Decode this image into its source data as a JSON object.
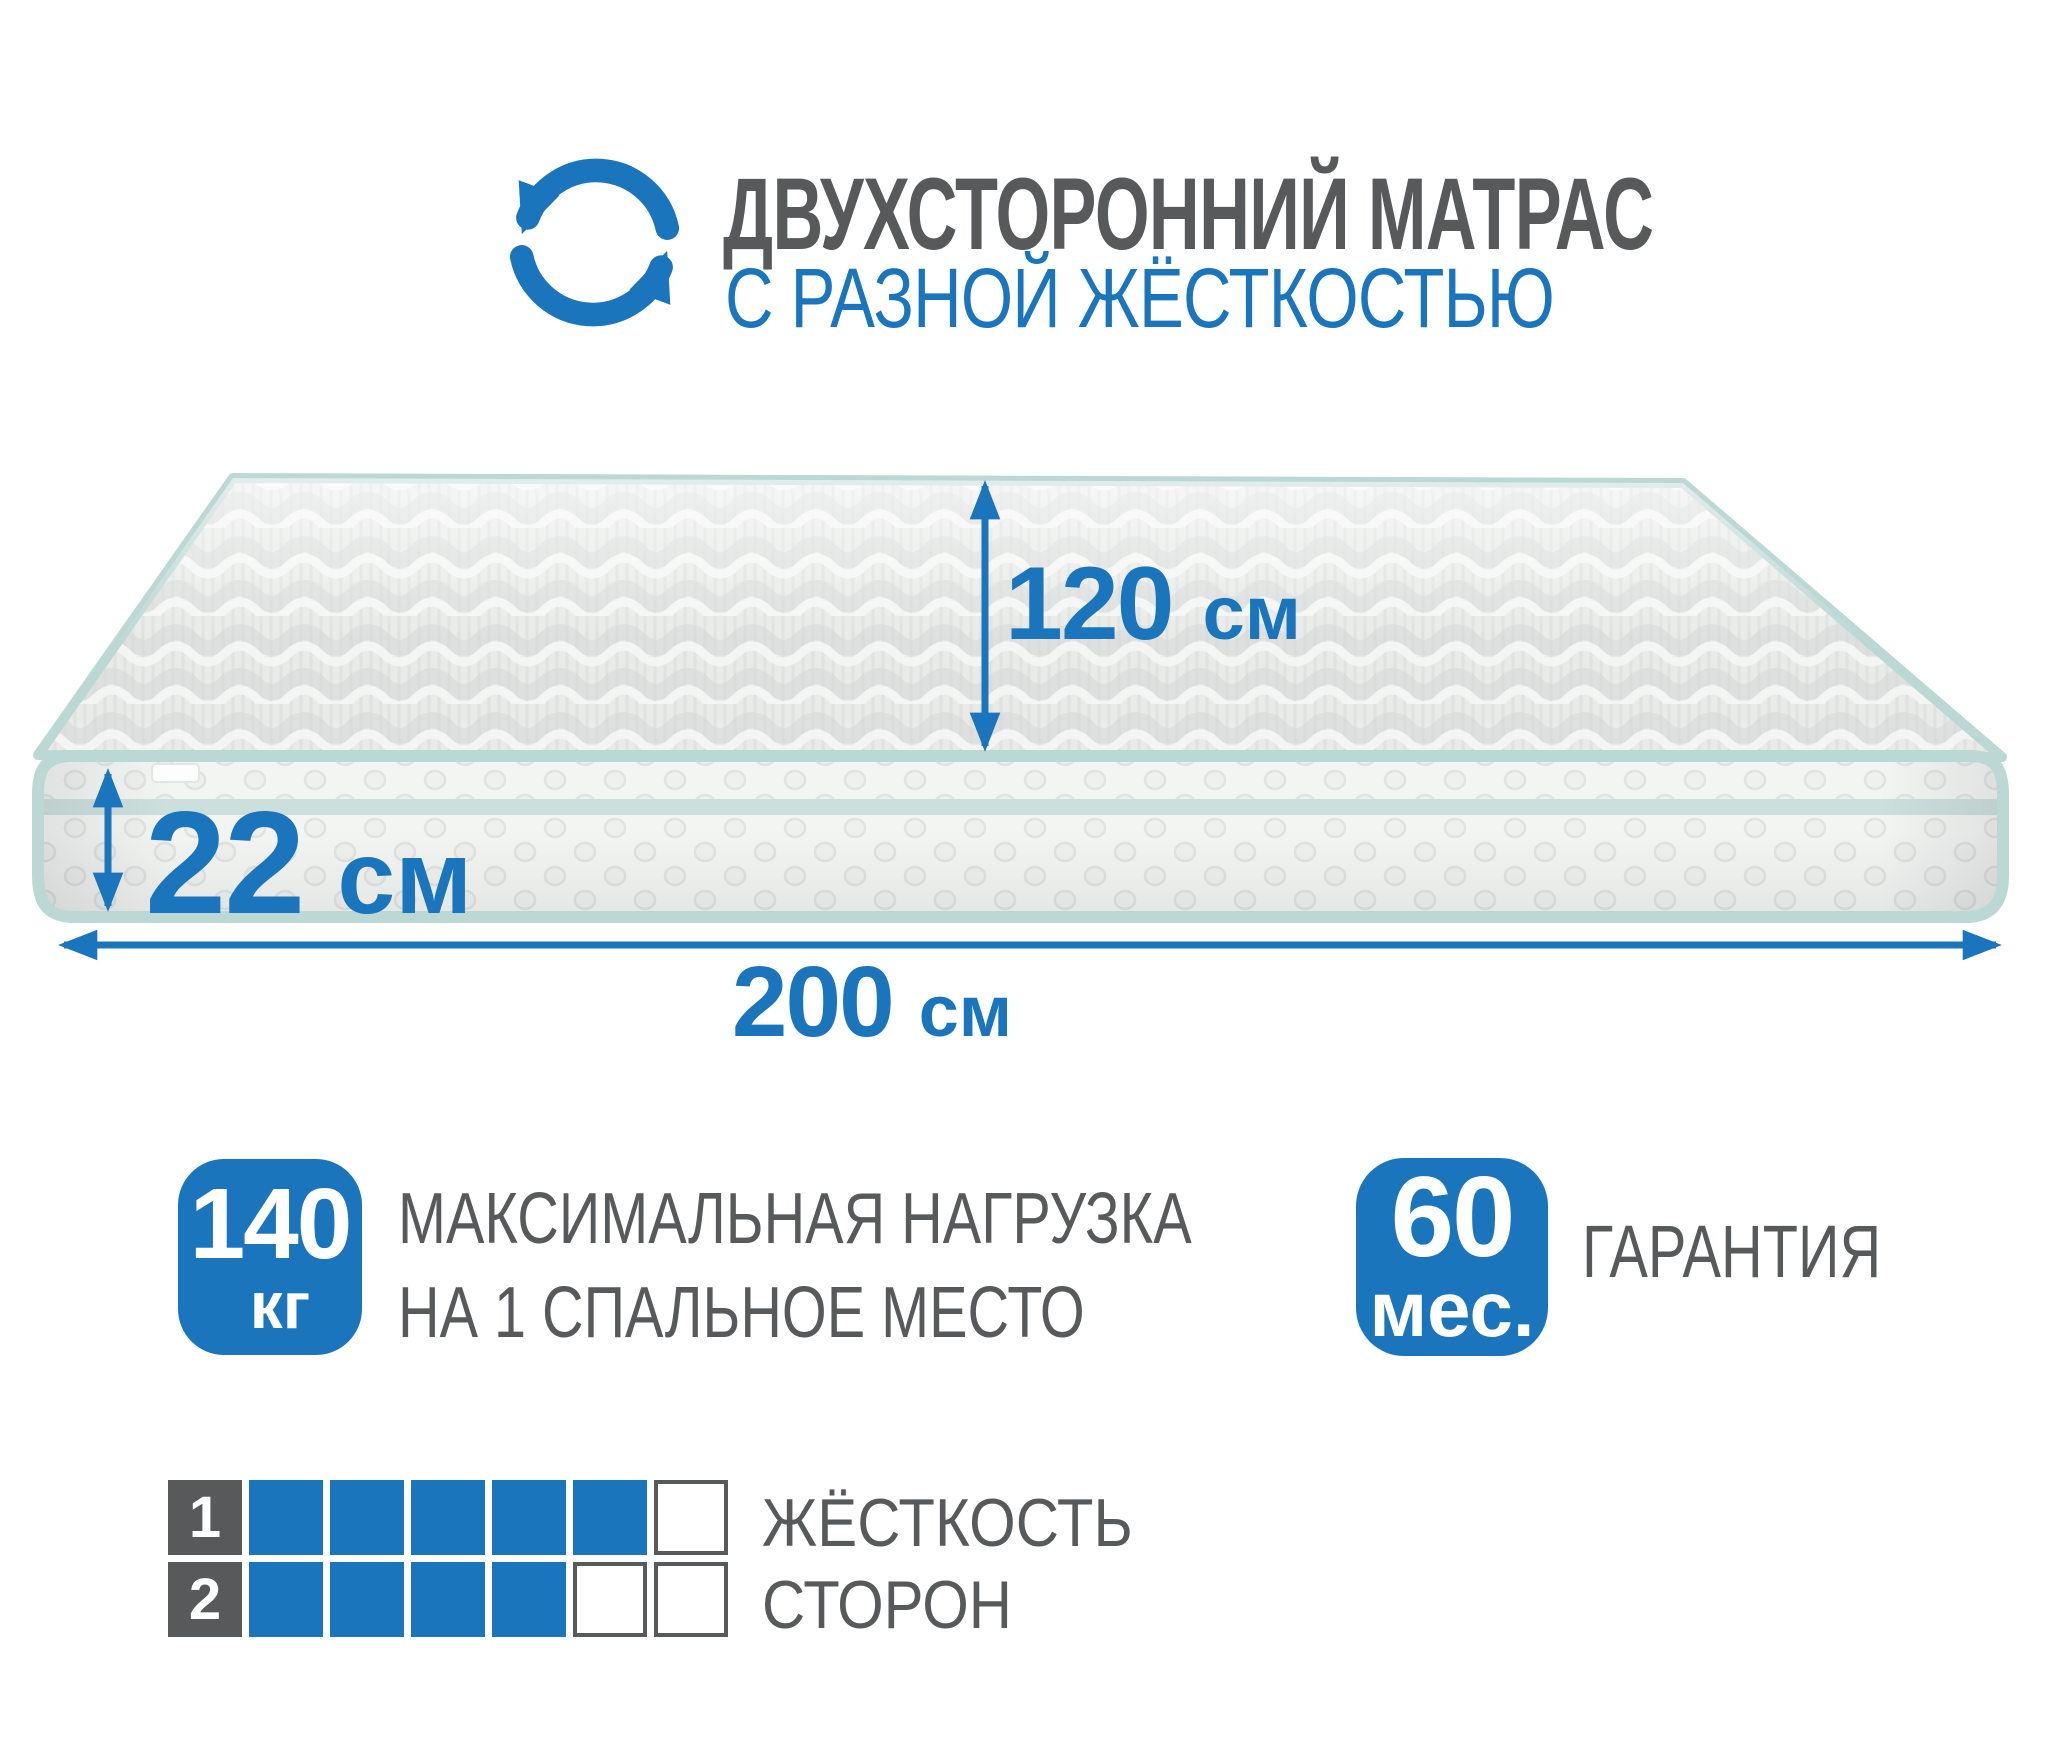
{
  "palette": {
    "blue": "#1b75bc",
    "gray": "#58595b",
    "mint": "#bcd8d5"
  },
  "header": {
    "icon": "rotate-arrows-icon",
    "title": "ДВУХСТОРОННИЙ МАТРАС",
    "subtitle": "С РАЗНОЙ ЖЁСТКОСТЬЮ"
  },
  "dimensions": {
    "width": {
      "value": "120",
      "unit": "см"
    },
    "height": {
      "value": "22",
      "unit": "см"
    },
    "length": {
      "value": "200",
      "unit": "см"
    }
  },
  "max_load": {
    "value": "140",
    "unit": "кг",
    "line1": "МАКСИМАЛЬНАЯ НАГРУЗКА",
    "line2": "НА 1 СПАЛЬНОЕ МЕСТО"
  },
  "warranty": {
    "value": "60",
    "unit": "мес.",
    "label": "ГАРАНТИЯ"
  },
  "firmness": {
    "line1": "ЖЁСТКОСТЬ",
    "line2": "СТОРОН",
    "scale_max": 6,
    "rows": [
      {
        "side": "1",
        "filled": 5
      },
      {
        "side": "2",
        "filled": 4
      }
    ]
  }
}
